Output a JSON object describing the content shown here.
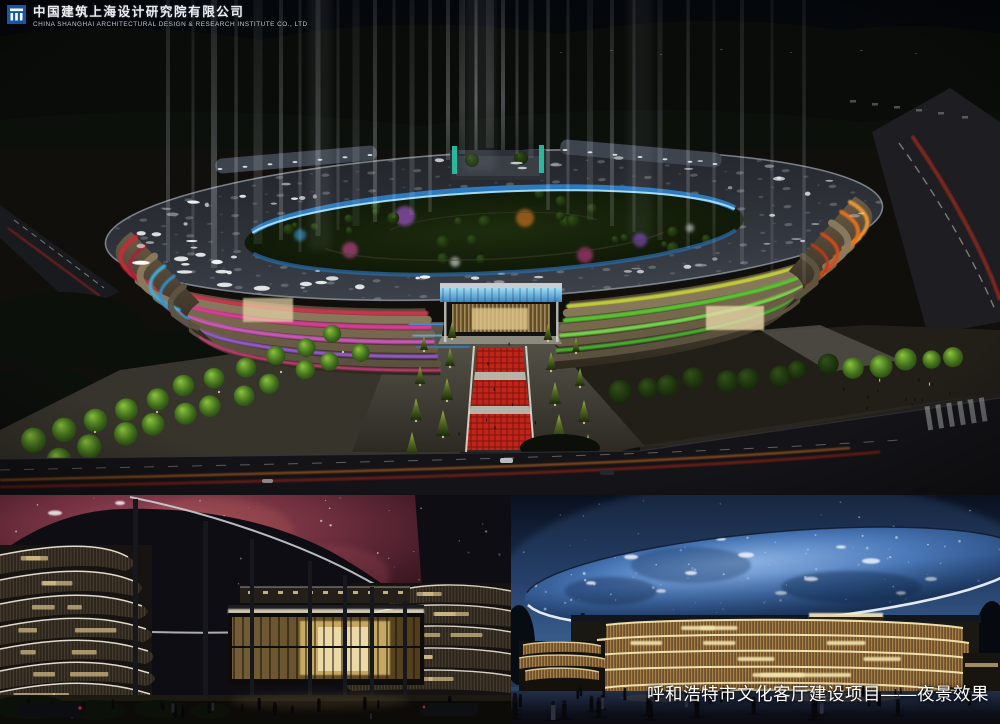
{
  "logo": {
    "company_name_zh": "中国建筑上海设计研究院有限公司",
    "company_name_en": "CHINA SHANGHAI ARCHITECTURAL DESIGN & RESEARCH INSTITUTE CO., LTD"
  },
  "caption": "呼和浩特市文化客厅建设项目——夜景效果",
  "colors": {
    "logo_blue": "#1656a6",
    "accent_red": "#cf3550",
    "accent_magenta": "#e03a9a",
    "accent_violet": "#9a5ad8",
    "accent_green": "#5bc832",
    "accent_yellow_green": "#c6d23c",
    "accent_orange": "#ef9630",
    "accent_orange_deep": "#e8701e",
    "accent_blue_glass": "#3f93d8",
    "inner_ring_blue": "#2f7ec6",
    "teal_fin": "#2ac8a8",
    "walkway_red": "#bf2619",
    "nebula_pink": "#9c4a5e",
    "dome_blue": "#4a78b8",
    "facade_warm": "#d9c08a"
  }
}
